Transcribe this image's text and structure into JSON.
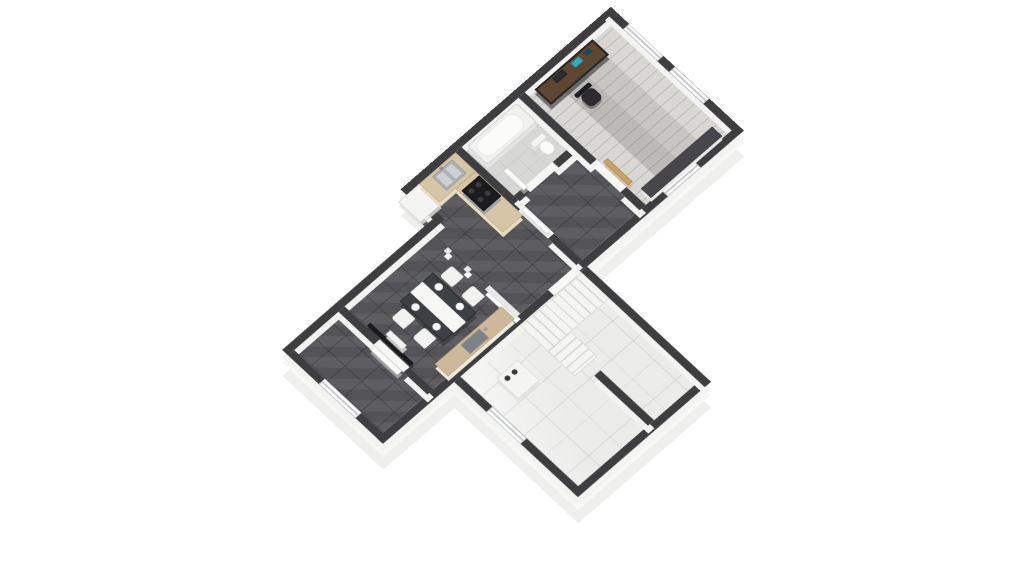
{
  "figure": {
    "kind": "3d-isometric-floor-plan-render",
    "background": "#ffffff",
    "stories_shown": 1
  },
  "palette": {
    "background": "#ffffff",
    "wall": "#3e3e41",
    "wall_face": "#f3f3f2",
    "plinth": "#efefee",
    "plinth_light": "#f7f7f6",
    "floor_dark": "#58575b",
    "floor_wood": "#c8c6c2",
    "floor_white_tile": "#ebebea",
    "floor_bath": "#d7d7d6",
    "counter_wood": "#d5c6a8",
    "sideboard_wood": "#cdb89a",
    "steel": "#aeb2b4",
    "appliance": "#f4f4f3",
    "stove": "#1c1c1e",
    "tv": "#1a1a1c",
    "desk_wood": "#5d4732",
    "chair_dark": "#2c2c2f",
    "door_wood": "#c8a26a",
    "stairs": "#f4f4f3"
  },
  "rooms": [
    {
      "name": "office",
      "floor": "light-wood-plank"
    },
    {
      "name": "bathroom",
      "floor": "light-tile"
    },
    {
      "name": "kitchen",
      "floor": "dark-tile"
    },
    {
      "name": "dining-living",
      "floor": "dark-tile"
    },
    {
      "name": "entry-room",
      "floor": "dark-tile"
    },
    {
      "name": "hallway",
      "floor": "dark-tile"
    },
    {
      "name": "utility-basement-room",
      "floor": "white-gloss-tile"
    }
  ],
  "furniture": [
    "office-desk-with-monitor-and-laptop",
    "office-swivel-chair",
    "office-low-sideboard",
    "bathtub",
    "toilet",
    "refrigerator-tall-cabinet",
    "kitchen-l-counter-with-double-sink",
    "stove-with-cooktop-and-oven",
    "dining-table-with-white-runner-and-plates",
    "dining-chairs-x4",
    "wall-mounted-tv",
    "media-shelf-under-tv",
    "sideboard-counter-with-sink",
    "l-shaped-staircase",
    "utility-appliance-with-two-burners",
    "glass-partition-posts"
  ],
  "openings": {
    "windows": [
      "entry-sw-wall",
      "office-ne-wall-1",
      "office-ne-wall-2",
      "hallway-se-wall",
      "utility-sw-wall"
    ],
    "doors": [
      "entry-white",
      "bathroom-white",
      "kitchen-hall-white",
      "office-wood"
    ]
  }
}
